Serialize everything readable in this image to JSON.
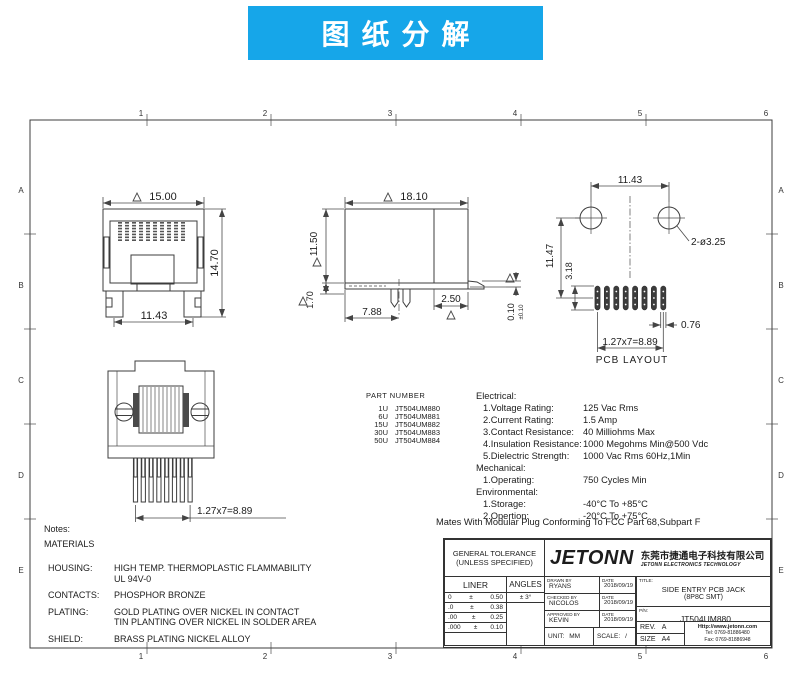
{
  "banner": {
    "title": "图纸分解",
    "bg": "#16a6e9"
  },
  "zones": {
    "cols": [
      "1",
      "2",
      "3",
      "4",
      "5",
      "6"
    ],
    "rows": [
      "A",
      "B",
      "C",
      "D",
      "E"
    ]
  },
  "dims": {
    "front": {
      "w": "15.00",
      "h": "14.70",
      "feet": "11.43"
    },
    "side": {
      "w": "18.10",
      "h": "11.50",
      "plate": "1.70",
      "leg": "7.88",
      "foot": "2.50",
      "standoff": "0.10",
      "standoff_tol": "±0.10"
    },
    "pcb": {
      "span": "11.43",
      "holes": "2-ø3.25",
      "height": "11.47",
      "pad_len": "3.18",
      "pad_w": "0.76",
      "pitch": "1.27x7=8.89",
      "label": "PCB LAYOUT"
    },
    "bottom": {
      "pitch": "1.27x7=8.89"
    }
  },
  "part_table": {
    "header": "PART NUMBER",
    "rows": [
      {
        "qty": "1U",
        "pn": "JT504UM880"
      },
      {
        "qty": "6U",
        "pn": "JT504UM881"
      },
      {
        "qty": "15U",
        "pn": "JT504UM882"
      },
      {
        "qty": "30U",
        "pn": "JT504UM883"
      },
      {
        "qty": "50U",
        "pn": "JT504UM884"
      }
    ]
  },
  "specs": {
    "electrical_heading": "Electrical:",
    "electrical": [
      {
        "label": "1.Voltage Rating:",
        "value": "125 Vac Rms"
      },
      {
        "label": "2.Current Rating:",
        "value": "1.5 Amp"
      },
      {
        "label": "3.Contact Resistance:",
        "value": "40 Milliohms Max"
      },
      {
        "label": "4.Insulation Resistance:",
        "value": "1000 Megohms Min@500 Vdc"
      },
      {
        "label": "5.Dielectric Strength:",
        "value": "1000 Vac Rms 60Hz,1Min"
      }
    ],
    "mechanical_heading": "Mechanical:",
    "mechanical": [
      {
        "label": "1.Operating:",
        "value": "750 Cycles Min"
      }
    ],
    "environmental_heading": "Environmental:",
    "environmental": [
      {
        "label": "1.Storage:",
        "value": "-40°C To +85°C"
      },
      {
        "label": "2.Opertion:",
        "value": "-20°C To +75°C"
      }
    ],
    "footnote": "Mates With Modular Plug Conforming To FCC Part 68,Subpart F"
  },
  "notes": {
    "title": "Notes:",
    "materials": "MATERIALS",
    "items": [
      {
        "label": "HOUSING:",
        "line1": "HIGH TEMP. THERMOPLASTIC FLAMMABILITY",
        "line2": "UL 94V-0"
      },
      {
        "label": "CONTACTS:",
        "line1": "PHOSPHOR BRONZE"
      },
      {
        "label": "PLATING:",
        "line1": "GOLD PLATING OVER NICKEL IN CONTACT",
        "line2": "TIN PLANTING OVER NICKEL IN SOLDER AREA"
      },
      {
        "label": "SHIELD:",
        "line1": "BRASS PLATING NICKEL ALLOY"
      }
    ]
  },
  "title_block": {
    "general_tolerance": "GENERAL TOLERANCE",
    "unless_specified": "(UNLESS SPECIFIED)",
    "liner": "LINER",
    "angles": "ANGLES",
    "angle_tol": "± 3°",
    "tol_rows": [
      {
        "dec": "0",
        "pm": "±",
        "val": "0.50"
      },
      {
        "dec": ".0",
        "pm": "±",
        "val": "0.38"
      },
      {
        "dec": ".00",
        "pm": "±",
        "val": "0.25"
      },
      {
        "dec": ".000",
        "pm": "±",
        "val": "0.10"
      }
    ],
    "logo": "JETONN",
    "company_cn": "东莞市捷通电子科技有限公司",
    "company_en": "JETONN ELECTRONICS TECHNOLOGY",
    "drawn_label": "DRAWN BY",
    "date_label": "DATE",
    "drawn_by": "RYANS",
    "drawn_date": "2018/09/19",
    "checked_label": "CHECKED BY",
    "checked_by": "NICOLOS",
    "checked_date": "2018/09/19",
    "approved_label": "APPROVED BY",
    "approved_by": "KEVIN",
    "approved_date": "2018/09/19",
    "unit_label": "UNIT:",
    "unit": "MM",
    "scale_label": "SCALE:",
    "scale": "/",
    "title_label": "TITLE:",
    "title_line1": "SIDE ENTRY PCB JACK",
    "title_line2": "(8P8C SMT)",
    "pn_label": "P/N:",
    "pn": "JT504UM880",
    "rev_label": "REV.",
    "rev": "A",
    "size_label": "SIZE",
    "size": "A4",
    "website": "Http://www.jetonn.com",
    "tel": "Tel: 0769-81886480",
    "fax": "Fax: 0769-81886948"
  }
}
